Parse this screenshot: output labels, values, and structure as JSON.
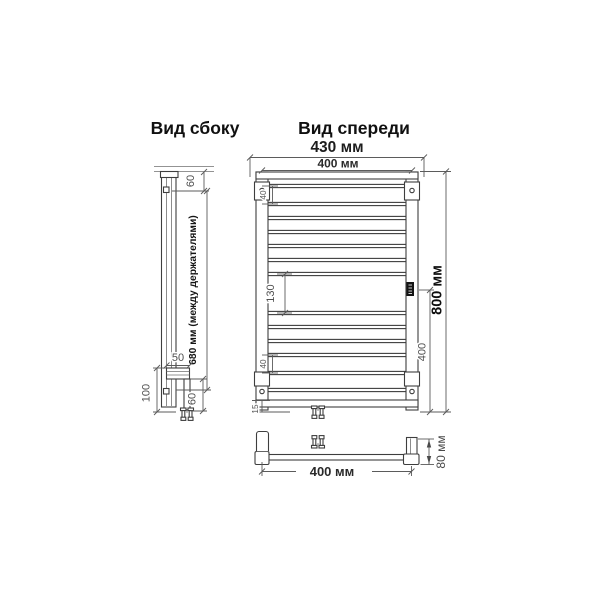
{
  "titles": {
    "side_view": "Вид сбоку",
    "front_view": "Вид спереди"
  },
  "dimensions": {
    "front": {
      "overall_width": "430 мм",
      "axis_width": "400 мм",
      "overall_height": "800 мм",
      "lower_span": "400",
      "center_gap": "130",
      "rung_gap_top": "40",
      "rung_gap_bottom": "40",
      "bottom_offset": "15"
    },
    "side": {
      "wall_offset_top": "60",
      "between_holders": "680 мм (между держателями)",
      "bracket_width": "50",
      "lower_section_height": "100",
      "leg_offset": "60"
    },
    "bottom": {
      "axis_width": "400 мм",
      "depth": "80 мм"
    }
  },
  "colors": {
    "line": "#4a4a4a",
    "text": "#222222",
    "badge": "#141414"
  }
}
